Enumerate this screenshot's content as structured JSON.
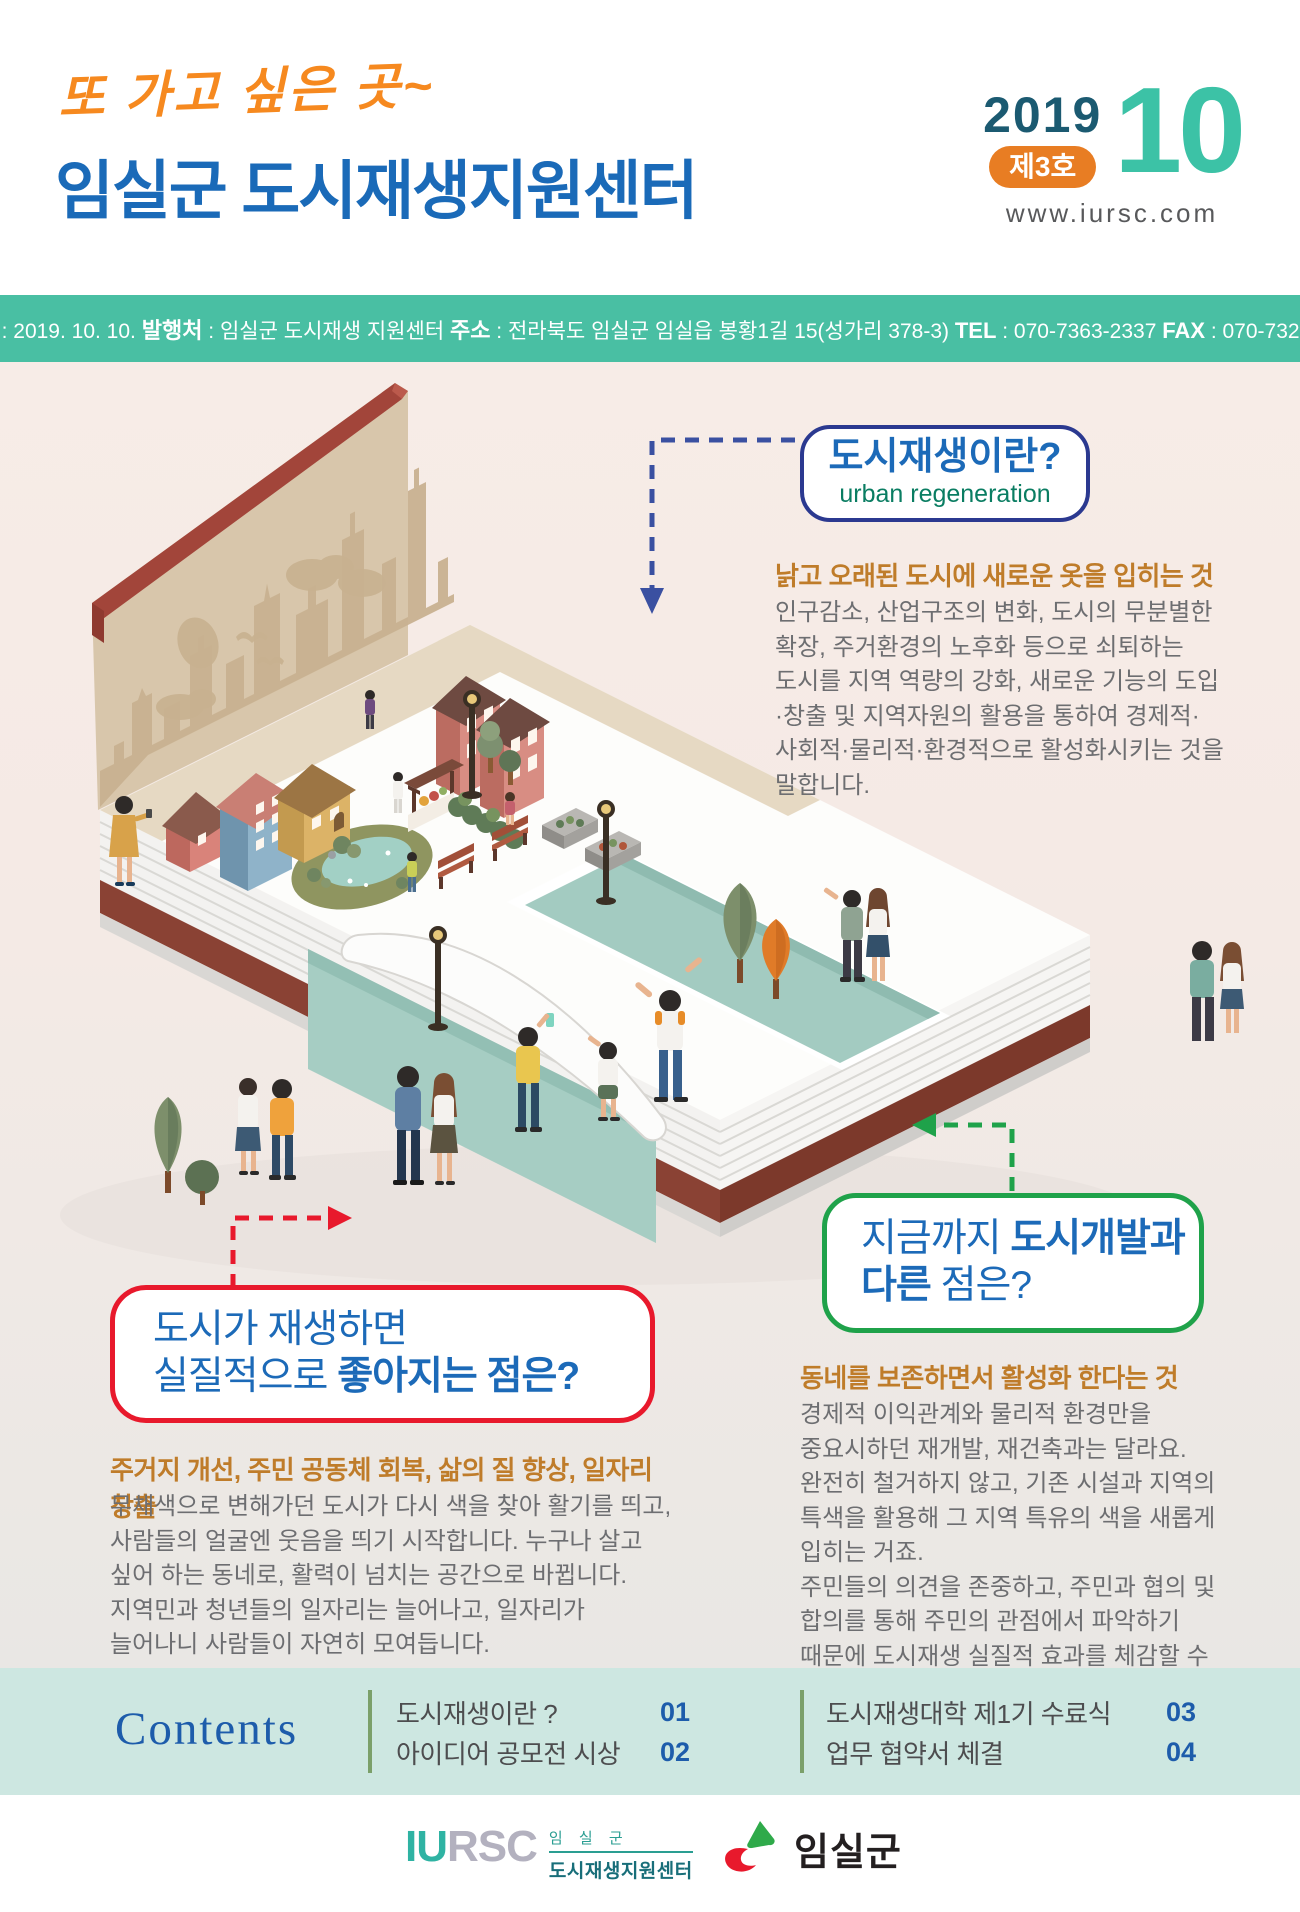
{
  "header": {
    "tagline": "또 가고 싶은 곳~",
    "title": "임실군 도시재생지원센터",
    "year": "2019",
    "issue_badge": "제3호",
    "month": "10",
    "website": "www.iursc.com"
  },
  "info_bar": {
    "publish_date_label": "발행일",
    "publish_date": " : 2019. 10. 10.  ",
    "publisher_label": "발행처",
    "publisher": " : 임실군 도시재생 지원센터  ",
    "address_label": "주소",
    "address": " : 전라북도 임실군 임실읍 봉황1길 15(성가리 378-3)  ",
    "tel_label": "TEL",
    "tel": " : 070-7363-2337  ",
    "fax_label": "FAX",
    "fax": " : 070-7326-2337"
  },
  "sections": {
    "what_is": {
      "bubble_title": "도시재생이란?",
      "bubble_subtitle": "urban regeneration",
      "heading": "낡고 오래된 도시에 새로운 옷을 입히는 것",
      "body": "인구감소, 산업구조의 변화, 도시의 무분별한 확장, 주거환경의 노후화 등으로 쇠퇴하는 도시를 지역 역량의 강화, 새로운 기능의 도입·창출 및 지역자원의 활용을 통하여 경제적·사회적·물리적·환경적으로 활성화시키는 것을 말합니다."
    },
    "benefits": {
      "bubble_line1": "도시가 재생하면",
      "bubble_line2_regular": "실질적으로 ",
      "bubble_line2_bold": "좋아지는 점은?",
      "heading": "주거지 개선, 주민 공동체 회복, 삶의 질 향상, 일자리 창출",
      "body": "무채색으로 변해가던 도시가 다시 색을 찾아 활기를 띄고, 사람들의 얼굴엔 웃음을 띄기 시작합니다. 누구나 살고 싶어 하는 동네로, 활력이 넘치는 공간으로 바뀝니다. 지역민과 청년들의 일자리는 늘어나고, 일자리가 늘어나니 사람들이 자연히 모여듭니다."
    },
    "difference": {
      "bubble_line1_regular": "지금까지 ",
      "bubble_line1_bold": "도시개발과",
      "bubble_line2_bold": "다른",
      "bubble_line2_regular": " 점은?",
      "heading": "동네를 보존하면서 활성화 한다는 것",
      "body1": "경제적 이익관계와 물리적 환경만을 중요시하던 재개발, 재건축과는 달라요. 완전히 철거하지 않고, 기존 시설과 지역의 특색을 활용해 그 지역 특유의 색을 새롭게 입히는 거죠.",
      "body2": "주민들의 의견을 존중하고, 주민과 협의 및 합의를 통해 주민의 관점에서 파악하기 때문에 도시재생 실질적 효과를 체감할 수 있습니다."
    }
  },
  "contents": {
    "title": "Contents",
    "items": [
      {
        "label": "도시재생이란 ?",
        "page": "01"
      },
      {
        "label": "아이디어 공모전 시상",
        "page": "02"
      },
      {
        "label": "도시재생대학 제1기 수료식",
        "page": "03"
      },
      {
        "label": "업무 협약서 체결",
        "page": "04"
      }
    ]
  },
  "footer": {
    "iursc_acronym_teal": "IU",
    "iursc_acronym_gray": "RSC",
    "iursc_sub1": "임 실 군",
    "iursc_sub2": "도시재생지원센터",
    "imsil_name": "임실군"
  },
  "colors": {
    "accent_teal_bar": "#49bfa3",
    "title_blue": "#1a6ab8",
    "tagline_orange": "#f6891f",
    "badge_orange": "#e87d23",
    "month_teal": "#3cc2a6",
    "heading_brown": "#bf7c2a",
    "body_gray": "#6d6e71",
    "bubble_navy_border": "#2b3990",
    "bubble_red_border": "#e8192c",
    "bubble_green_border": "#1fa24a",
    "contents_bg": "#cde7e1"
  }
}
